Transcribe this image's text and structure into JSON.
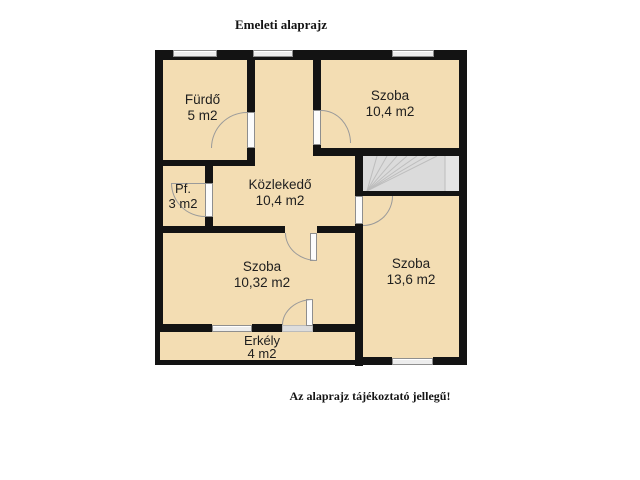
{
  "title": "Emeleti alaprajz",
  "disclaimer": "Az alaprajz tájékoztató jellegű!",
  "colors": {
    "room_fill": "#F3DDB3",
    "wall": "#131313",
    "stairs_fill": "#DBDBDB",
    "stairs_line": "#BDBDBD",
    "window_fill": "#EDEDED",
    "door_leaf": "#FCFCFC",
    "door_arc": "#9A9A9A",
    "label_text": "#1E1E1E"
  },
  "rooms": {
    "furdo": {
      "name": "Fürdő",
      "area": "5 m2"
    },
    "szoba_top": {
      "name": "Szoba",
      "area": "10,4 m2"
    },
    "pf": {
      "name": "Pf.",
      "area": "3 m2"
    },
    "kozlekedo": {
      "name": "Közlekedő",
      "area": "10,4 m2"
    },
    "szoba_left": {
      "name": "Szoba",
      "area": "10,32 m2"
    },
    "szoba_right": {
      "name": "Szoba",
      "area": "13,6 m2"
    },
    "erkely": {
      "name": "Erkély",
      "area": "4 m2"
    }
  }
}
